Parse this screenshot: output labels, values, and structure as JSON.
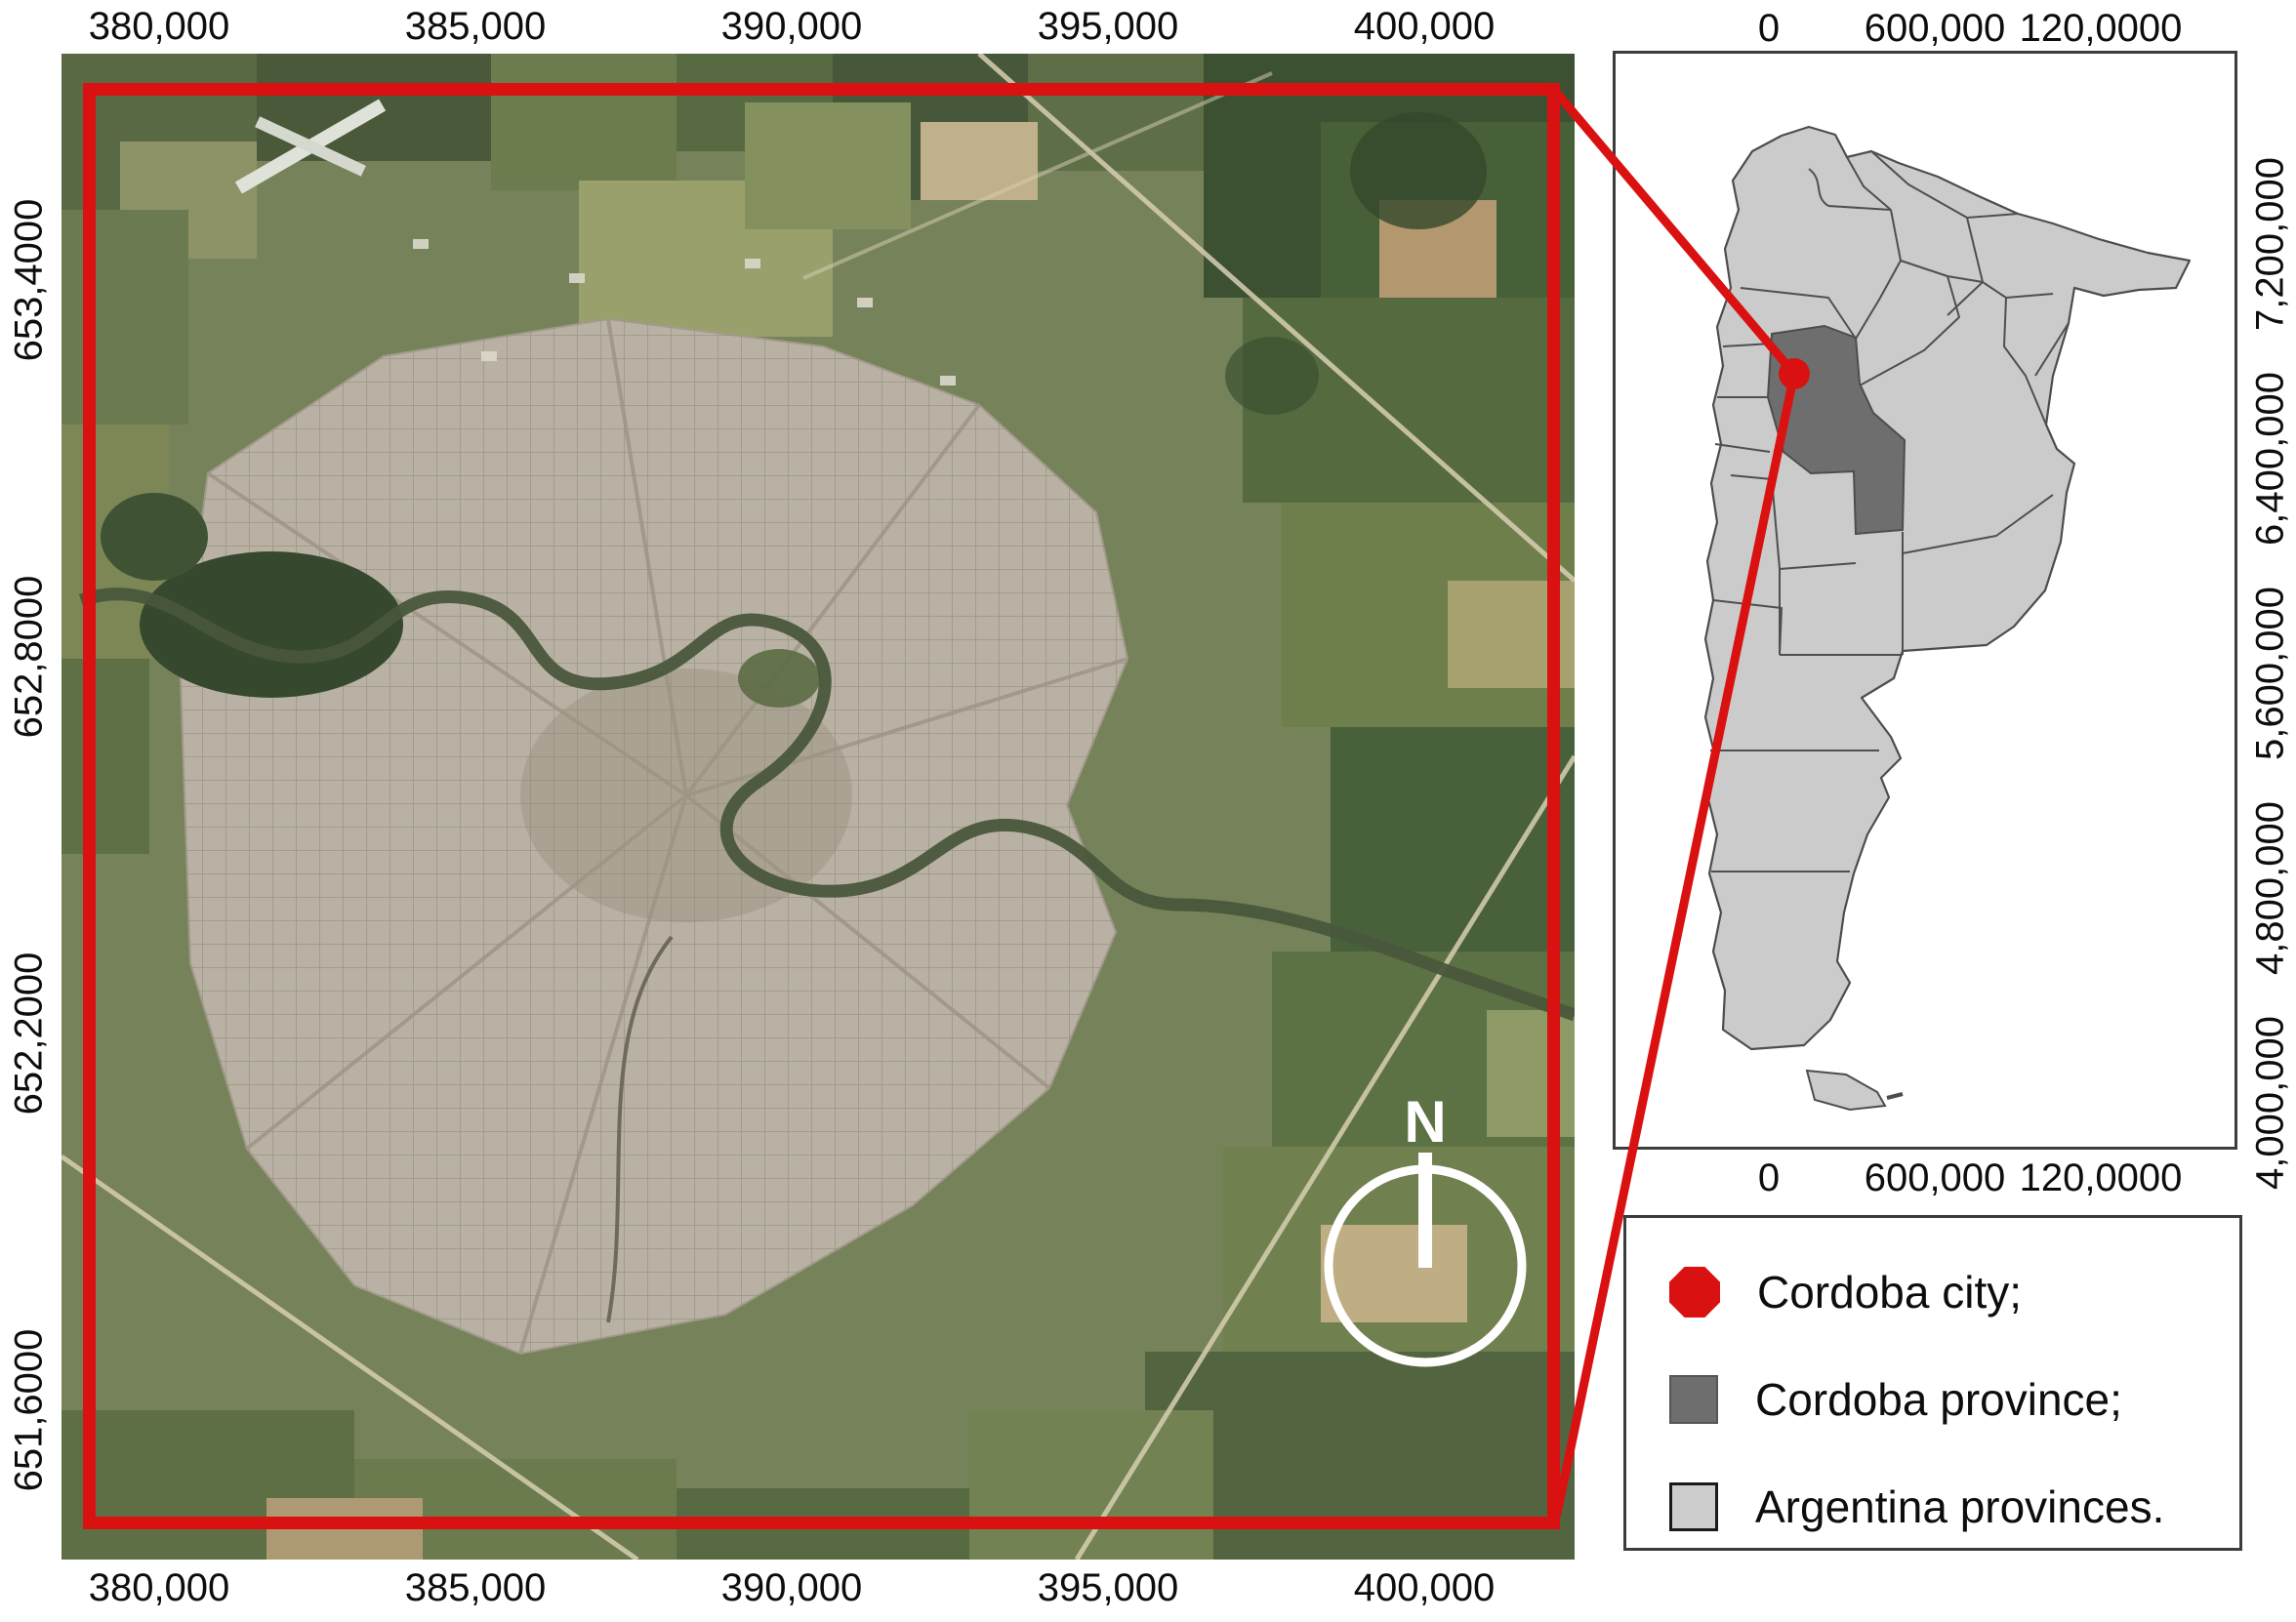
{
  "figure": {
    "type": "study-area-location-map",
    "background": "#ffffff",
    "accent_red": "#da1111"
  },
  "main_map": {
    "description": "Satellite image of Cordoba city and surroundings with red extent rectangle",
    "x_ticks": [
      "380,000",
      "385,000",
      "390,000",
      "395,000",
      "400,000"
    ],
    "y_ticks": [
      "653,4000",
      "652,8000",
      "652,2000",
      "651,6000"
    ],
    "north_label": "N",
    "extent_color": "#da1111"
  },
  "inset_map": {
    "description": "Argentina provinces map with Cordoba province highlighted and Cordoba city dot",
    "x_ticks": [
      "0",
      "600,000",
      "120,0000"
    ],
    "y_ticks": [
      "7,200,000",
      "6,400,000",
      "5,600,000",
      "4,800,000",
      "4,000,000"
    ],
    "province_fill": "#cbcbcb",
    "cordoba_fill": "#6e6e6e",
    "border_color": "#4d4d4d"
  },
  "legend": {
    "items": [
      {
        "label": "Cordoba city;",
        "marker": "red-octagon",
        "color": "#da1111"
      },
      {
        "label": "Cordoba province;",
        "marker": "dark-gray-square",
        "color": "#6e6e6e"
      },
      {
        "label": "Argentina provinces.",
        "marker": "light-gray-square",
        "color": "#cdcdcd"
      }
    ]
  }
}
